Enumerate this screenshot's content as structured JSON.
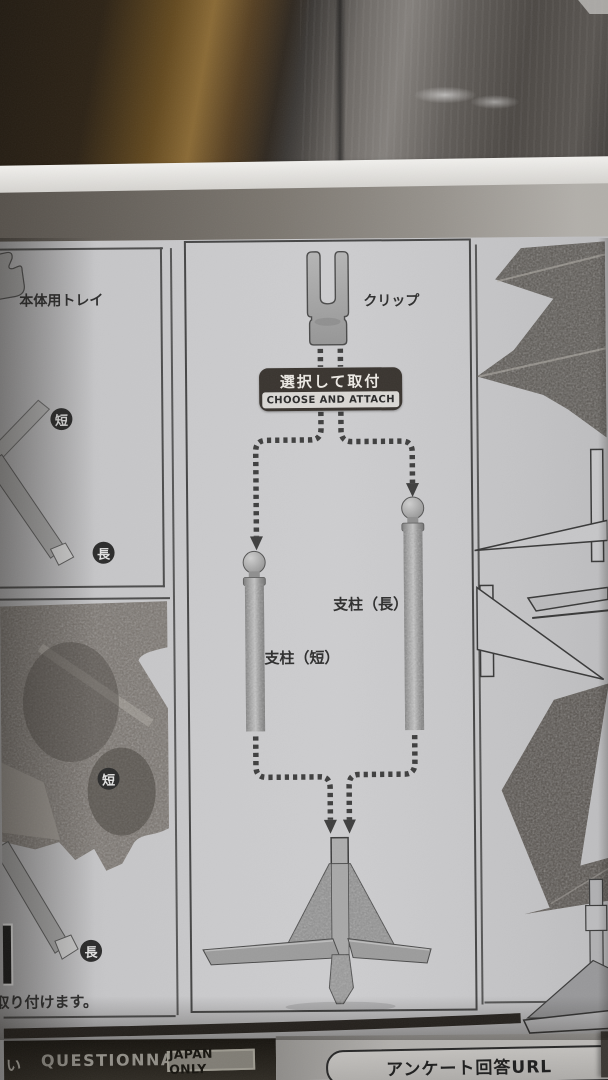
{
  "left_panel": {
    "tray_label": "本体用トレイ",
    "badge_short": "短",
    "badge_long": "長"
  },
  "center_panel": {
    "clip_label": "クリップ",
    "banner": {
      "jp": "選択して取付",
      "en": "CHOOSE AND ATTACH"
    },
    "pillar_long_label": "支柱（長）",
    "pillar_short_label": "支柱（短）"
  },
  "bottom_left": {
    "badge_short": "短",
    "badge_long": "長",
    "instruction_text": "取り付けます。"
  },
  "footer": {
    "partial_jp": "い",
    "questionnaire": "QUESTIONNAIRE",
    "japan_only": "JAPAN ONLY",
    "url_label": "アンケート回答URL"
  },
  "colors": {
    "paper": "#c6c6c8",
    "ink": "#2e2e2e",
    "banner_bg": "#39342f",
    "badge_bg": "#2b2b2b",
    "photo_dark": "#4f4a45",
    "footer_dark": "#1c1813"
  }
}
